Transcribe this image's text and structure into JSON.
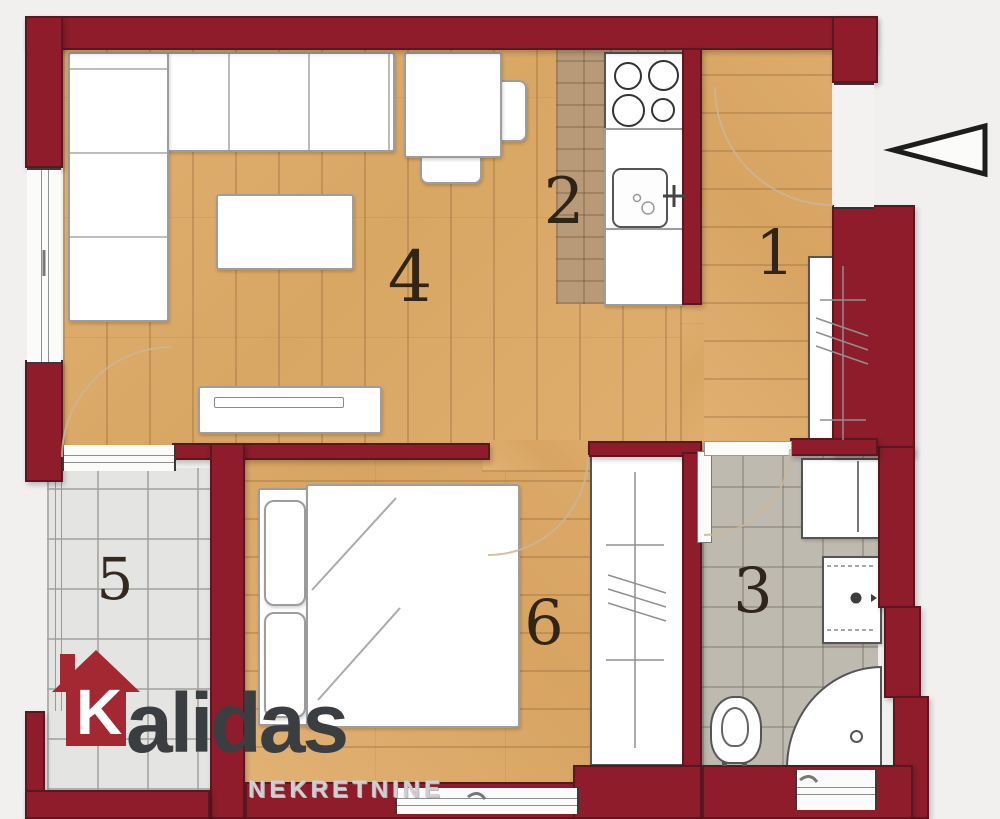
{
  "plan": {
    "background_color": "#f1f0ee",
    "wall_color": "#8e1c2b",
    "wood_floor_color": "#daa868",
    "kitchen_tile_color": "#b89a78",
    "bathroom_tile_color": "#bfbab0",
    "terrace_tile_color": "#e4e4e2",
    "rooms": [
      {
        "name": "entry-hall",
        "number": "1"
      },
      {
        "name": "kitchen",
        "number": "2"
      },
      {
        "name": "bathroom",
        "number": "3"
      },
      {
        "name": "living-room",
        "number": "4"
      },
      {
        "name": "terrace",
        "number": "5"
      },
      {
        "name": "bedroom",
        "number": "6"
      }
    ],
    "entrance_arrow_direction": "left"
  },
  "logo": {
    "initial": "K",
    "wordmark_rest": "alidas",
    "subtitle": "NEKRETNINE",
    "house_color": "#a42832",
    "text_color": "#3a3e41",
    "subtitle_color": "#cfcfcf"
  }
}
